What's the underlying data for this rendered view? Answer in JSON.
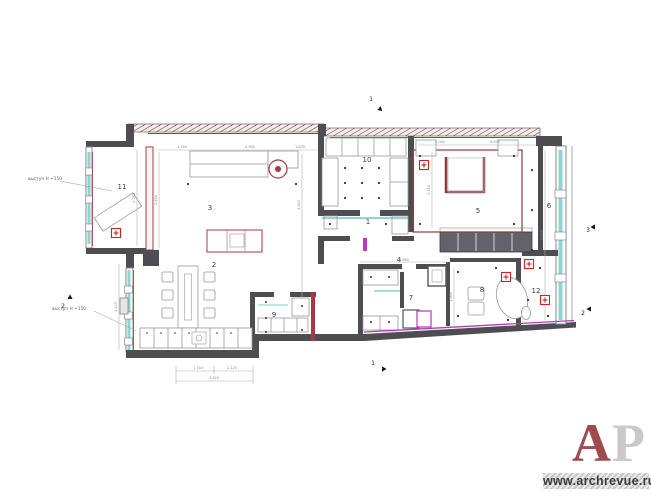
{
  "watermark": {
    "letter_a": "A",
    "letter_p": "P",
    "url": "www.archrevue.ru",
    "a_color": "#9d4b4f",
    "p_color": "#c9c9c9"
  },
  "annotations": [
    {
      "text": "выступ Н +150",
      "x": 28,
      "y": 180
    },
    {
      "text": "выступ Н +150",
      "x": 52,
      "y": 310
    }
  ],
  "rooms": [
    {
      "n": "11",
      "x": 122,
      "y": 189
    },
    {
      "n": "3",
      "x": 210,
      "y": 210
    },
    {
      "n": "10",
      "x": 367,
      "y": 162
    },
    {
      "n": "1",
      "x": 368,
      "y": 224
    },
    {
      "n": "2",
      "x": 214,
      "y": 267
    },
    {
      "n": "4",
      "x": 399,
      "y": 262
    },
    {
      "n": "5",
      "x": 478,
      "y": 213
    },
    {
      "n": "6",
      "x": 549,
      "y": 208
    },
    {
      "n": "7",
      "x": 411,
      "y": 300
    },
    {
      "n": "9",
      "x": 274,
      "y": 317
    },
    {
      "n": "8",
      "x": 482,
      "y": 292
    },
    {
      "n": "12",
      "x": 536,
      "y": 293
    }
  ],
  "section_markers": [
    {
      "label": "1",
      "x": 371,
      "y": 101,
      "ax": 379,
      "ay": 108,
      "rot": 45
    },
    {
      "label": "2",
      "x": 63,
      "y": 308,
      "ax": 70,
      "ay": 299,
      "rot": -90
    },
    {
      "label": "1",
      "x": 373,
      "y": 365,
      "ax": 382,
      "ay": 369,
      "rot": 0
    },
    {
      "label": "3",
      "x": 588,
      "y": 232,
      "ax": 595,
      "ay": 227,
      "rot": 180
    },
    {
      "label": "2",
      "x": 583,
      "y": 315,
      "ax": 591,
      "ay": 309,
      "rot": 180
    }
  ],
  "cross_markers": [
    {
      "x": 116,
      "y": 233
    },
    {
      "x": 424,
      "y": 165
    },
    {
      "x": 506,
      "y": 277
    },
    {
      "x": 529,
      "y": 264
    },
    {
      "x": 545,
      "y": 300
    }
  ],
  "dimensions": [
    {
      "t": "1.164",
      "x": 182,
      "y": 148,
      "r": 0
    },
    {
      "t": "2.985",
      "x": 250,
      "y": 148,
      "r": 0
    },
    {
      "t": "1.830",
      "x": 300,
      "y": 148,
      "r": 0
    },
    {
      "t": "2.040",
      "x": 440,
      "y": 143,
      "r": 0
    },
    {
      "t": "4.630",
      "x": 495,
      "y": 143,
      "r": 0
    },
    {
      "t": "1.985",
      "x": 404,
      "y": 261,
      "r": 0
    },
    {
      "t": "1.740",
      "x": 198,
      "y": 369,
      "r": 0
    },
    {
      "t": "2.120",
      "x": 232,
      "y": 369,
      "r": 0
    },
    {
      "t": "3.625",
      "x": 214,
      "y": 379,
      "r": 0
    },
    {
      "t": "3.640",
      "x": 300,
      "y": 205,
      "r": -90
    },
    {
      "t": "2.460",
      "x": 157,
      "y": 200,
      "r": -90
    },
    {
      "t": "2.280",
      "x": 135,
      "y": 198,
      "r": -90
    },
    {
      "t": "1.250",
      "x": 430,
      "y": 190,
      "r": -90
    },
    {
      "t": "2.630",
      "x": 543,
      "y": 235,
      "r": -90
    },
    {
      "t": "1.060",
      "x": 452,
      "y": 297,
      "r": -90
    },
    {
      "t": "3.120",
      "x": 117,
      "y": 307,
      "r": -90
    }
  ],
  "colors": {
    "wall": "#4e4e52",
    "red": "#a8393f",
    "maroon": "#8f3a40",
    "cyan": "#8fd4d4",
    "cyan_line": "#49bdbd",
    "magenta": "#b83ab8",
    "marker_red": "#cc2222",
    "dim": "#b0b0b0"
  }
}
